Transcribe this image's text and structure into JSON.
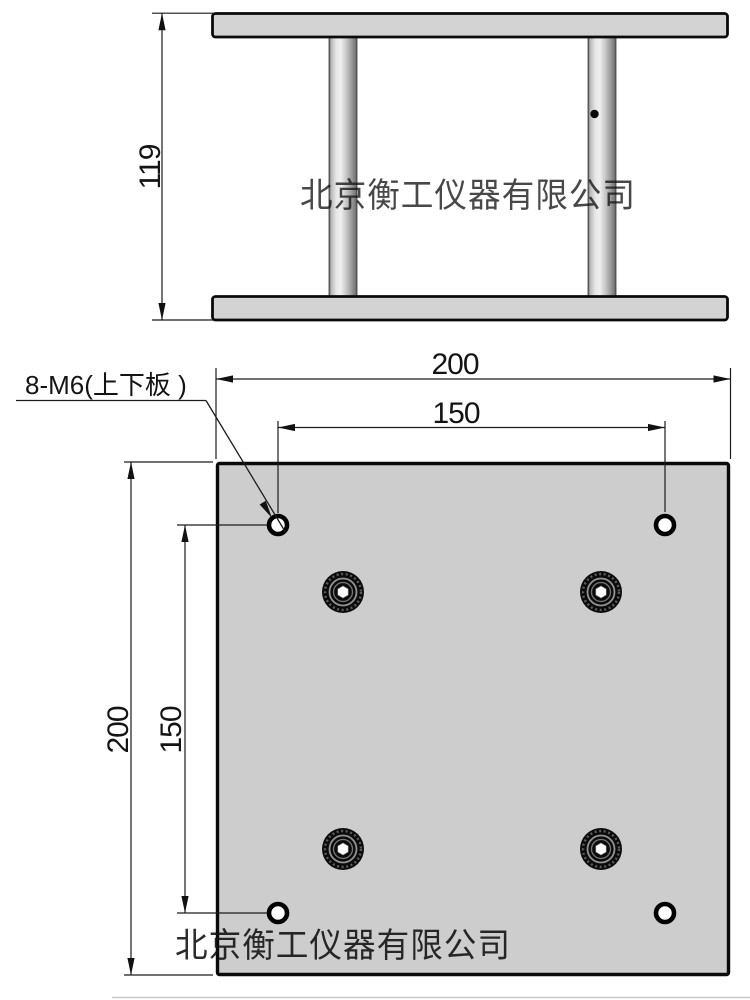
{
  "watermark": {
    "text": "北京衡工仪器有限公司"
  },
  "side_view": {
    "height_dim": "119"
  },
  "plan_view": {
    "width_dim": "200",
    "height_dim": "200",
    "hole_pitch_horizontal_dim": "150",
    "hole_pitch_vertical_dim": "150",
    "thread_callout": "8-M6(上下板 )"
  },
  "colors": {
    "line": "#1c1c1c",
    "plate_fill_side": "#d3d3d3",
    "plate_fill_plan": "#cdcdcd",
    "watermark_top": "#c6c6c6",
    "watermark_bottom": "#b3b3b3"
  }
}
